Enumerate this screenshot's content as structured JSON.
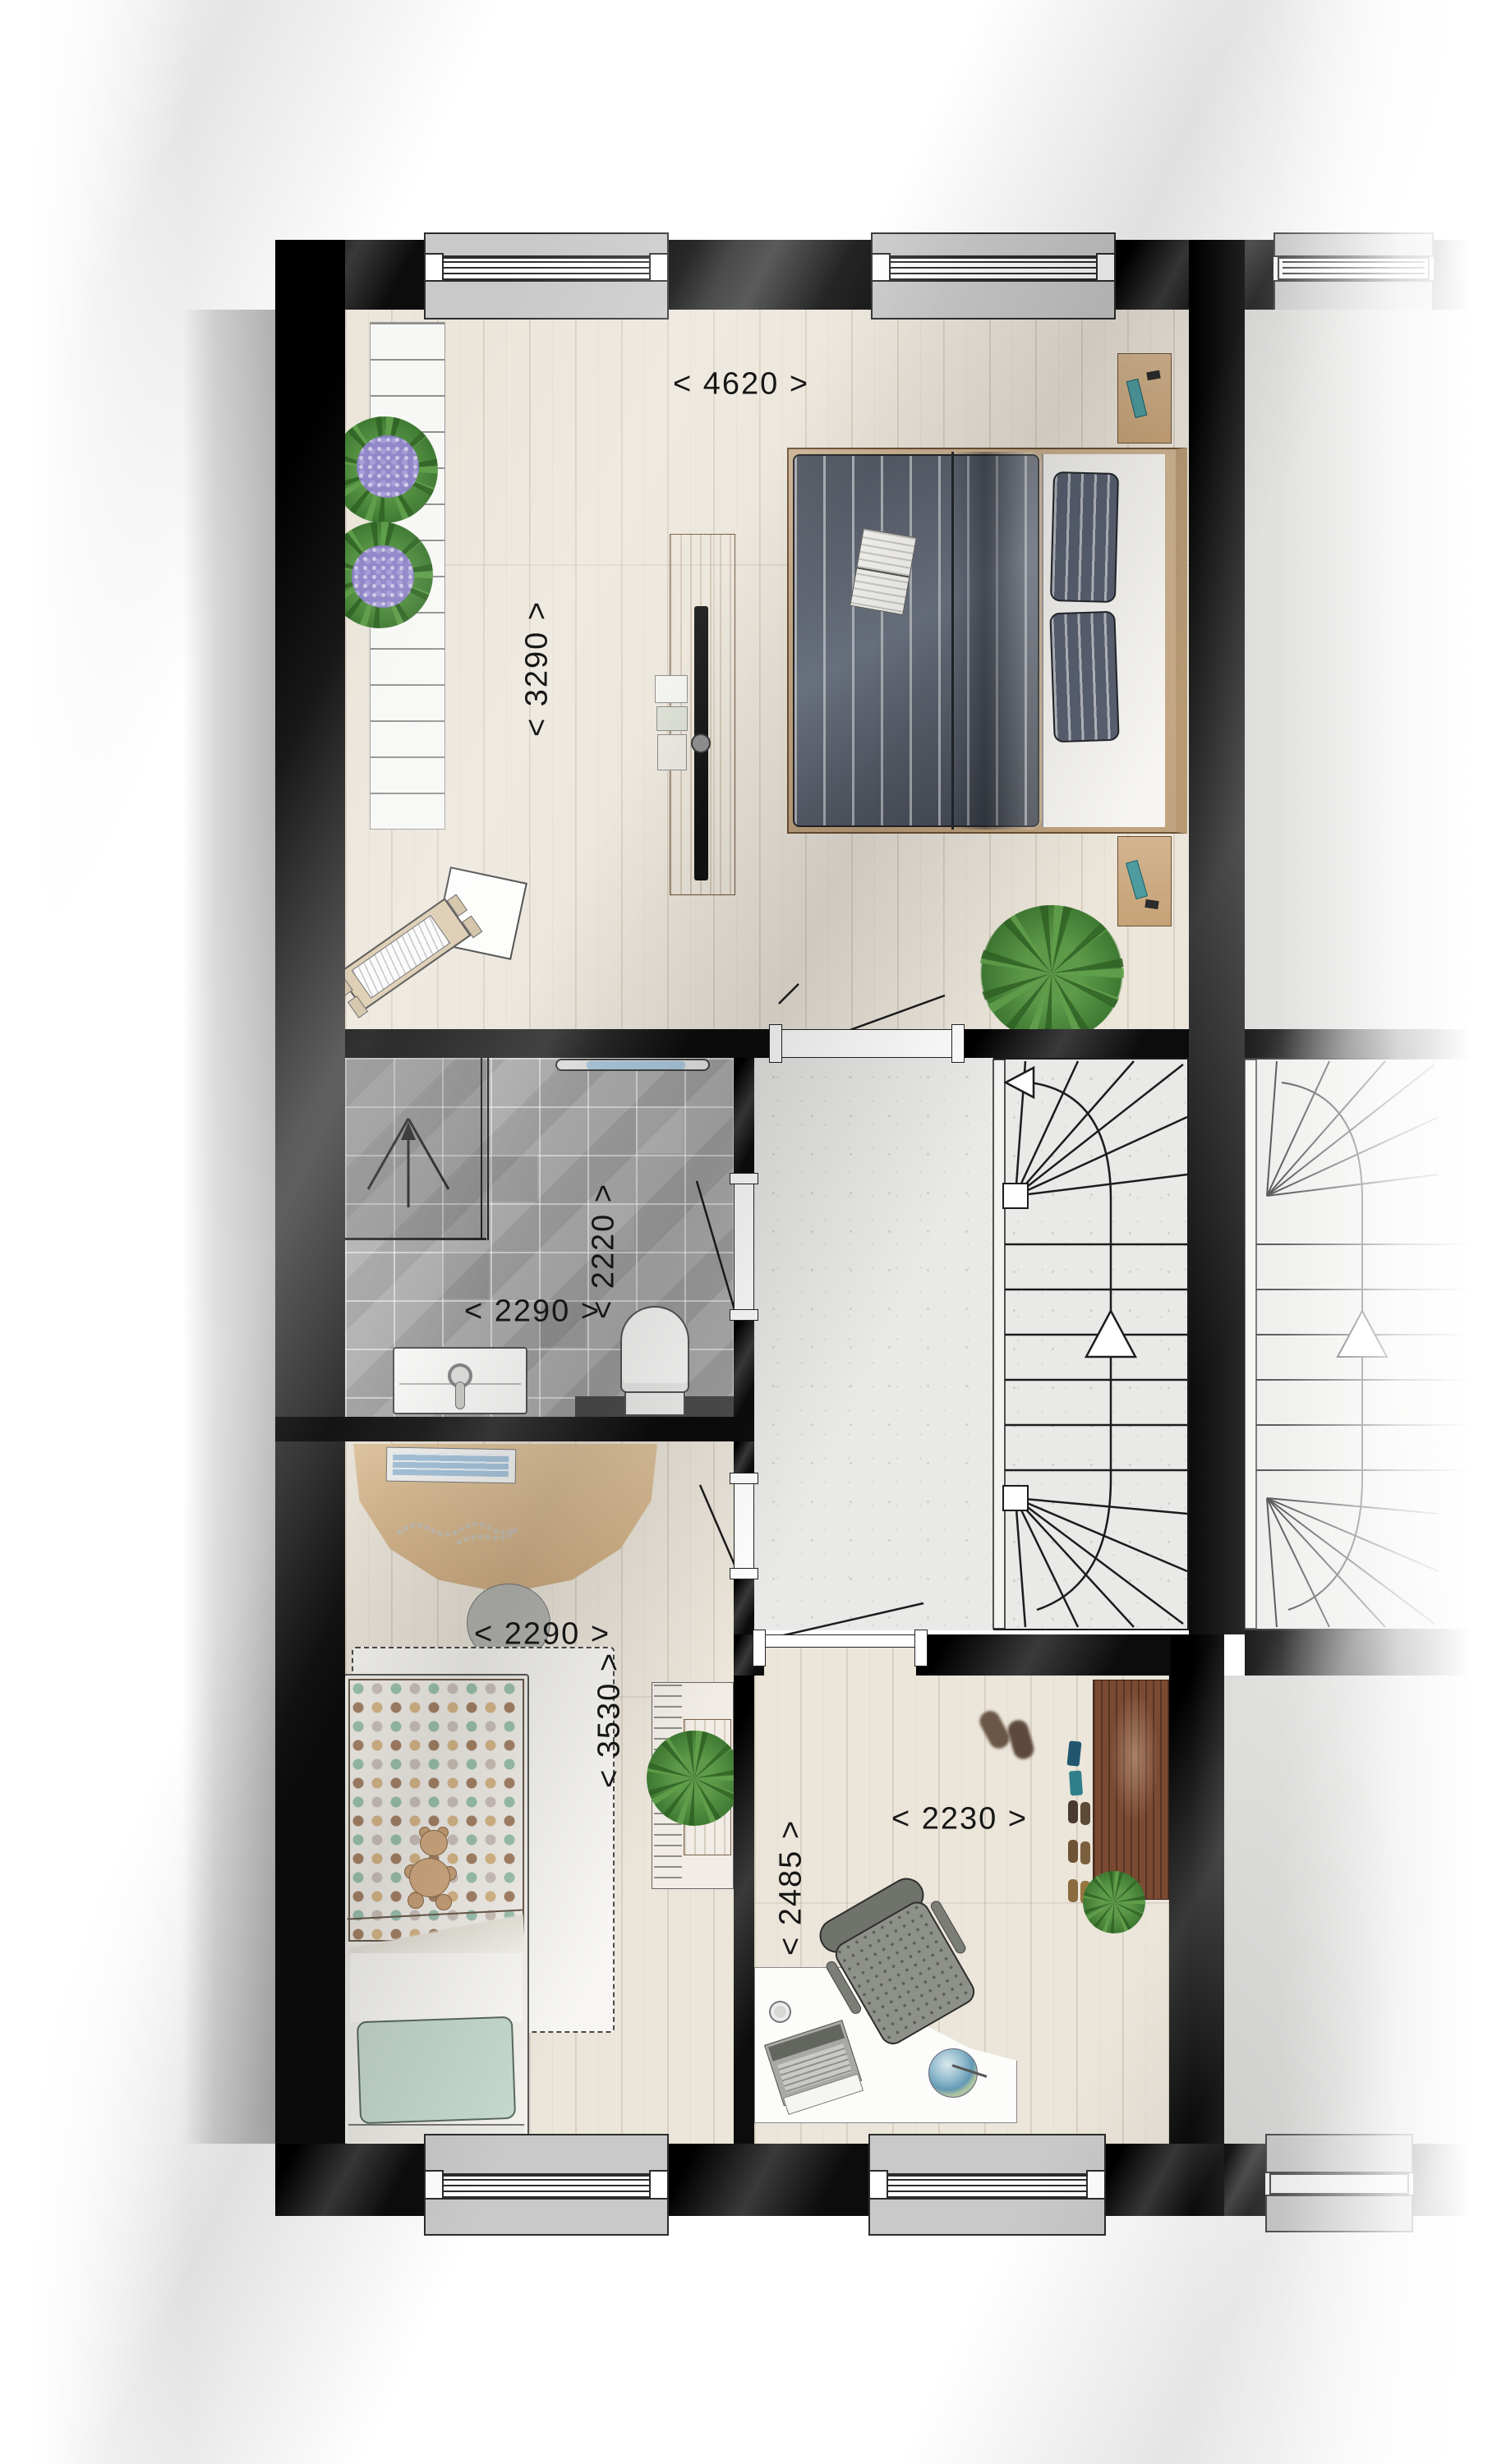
{
  "labels": {
    "master_width": "< 4620 >",
    "master_depth": "< 3290 >",
    "bath_depth": "< 2220 >",
    "bath_width": "< 2290 >",
    "bed2_width": "< 2290 >",
    "bed2_depth": "< 3530 >",
    "study_depth": "< 2485 >",
    "study_width": "< 2230 >"
  },
  "icons": {
    "stair_entry": "left-filled-arrow",
    "stair_direction": "up-open-triangle-arrow",
    "shower_slope": "up-arrow-between-slope-lines"
  },
  "colors": {
    "wallSoft": "#3a3a3a",
    "wood": "#ebe5da",
    "tile": "#a8a8a8",
    "concrete": "#e9e9e7",
    "sill": "#c9c9c9",
    "accentWood": "#d3b590",
    "darkWood": "#7c4a33",
    "duvet": "#59606b",
    "mint": "#c5d9cf",
    "towel": "#aac8dd",
    "label": "#161616"
  }
}
